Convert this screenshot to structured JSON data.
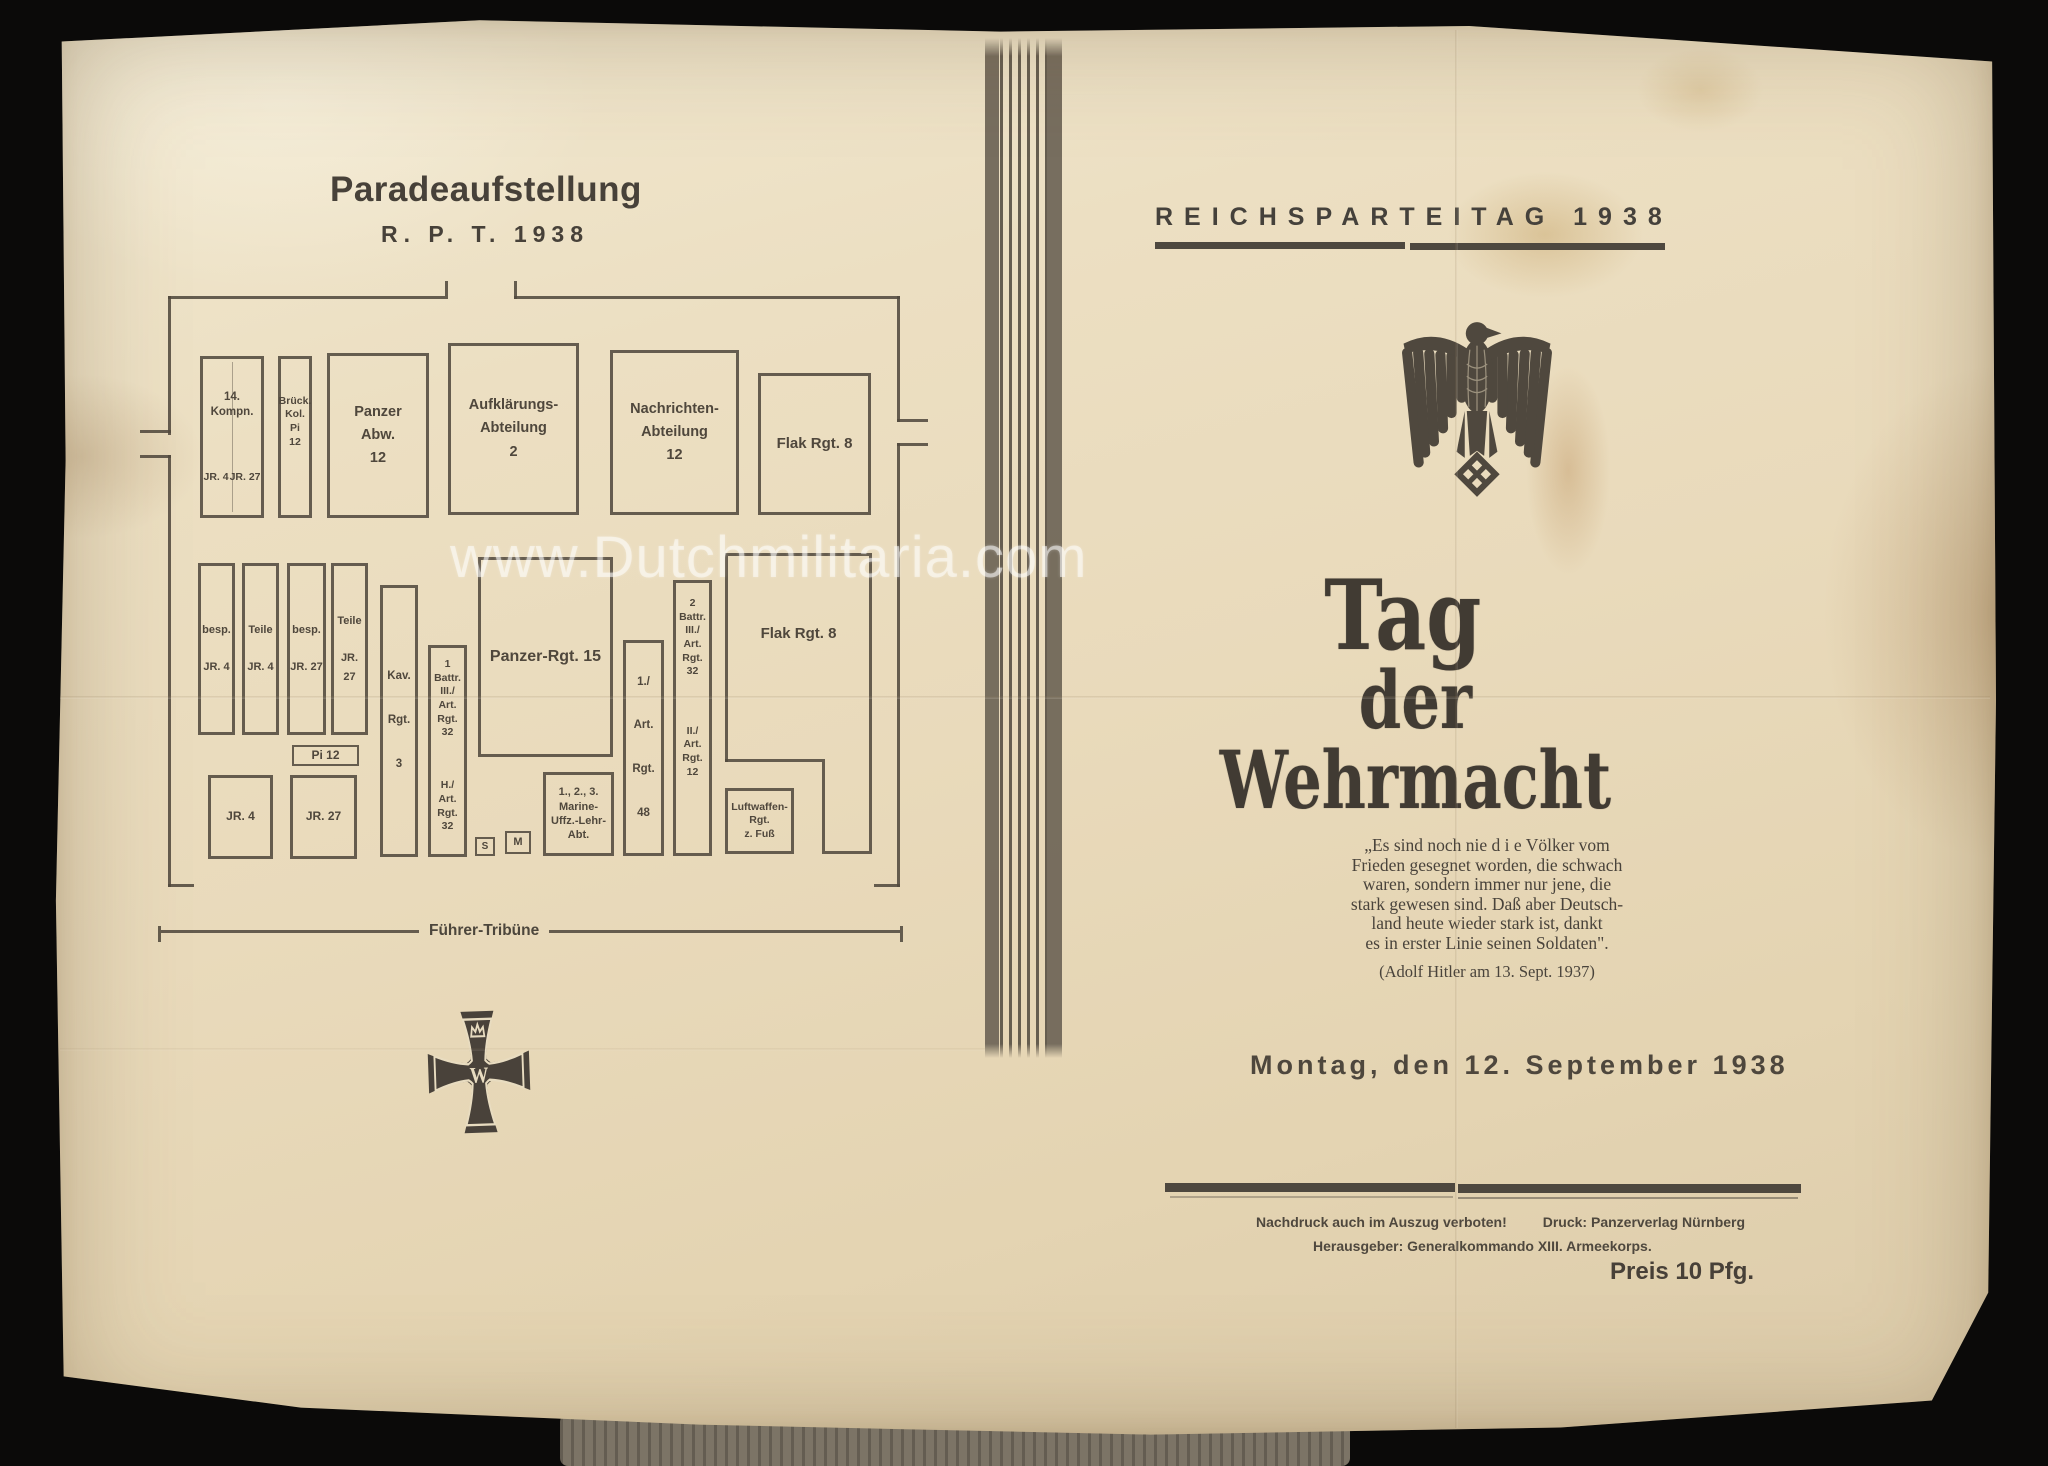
{
  "photo": {
    "watermark": "www.Dutchmilitaria.com"
  },
  "left_page": {
    "title": "Paradeaufstellung",
    "subtitle": "R. P. T. 1938",
    "tribune_label": "Führer-Tribüne",
    "cross_monogram": "W",
    "boxes": {
      "kompn14": "14. Kompn.",
      "kompn14_jr4": "JR. 4",
      "kompn14_jr27": "JR. 27",
      "brueck": "Brück.\nKol.\nPi\n12",
      "panzer_abw": "Panzer\nAbw.\n12",
      "aufklaerungs": "Aufklärungs-\nAbteilung\n2",
      "nachrichten": "Nachrichten-\nAbteilung\n12",
      "flak_rgt8_top": "Flak Rgt. 8",
      "besp_jr4": "besp.\n\nJR. 4",
      "teile_jr4": "Teile\n\nJR. 4",
      "besp_jr27": "besp.\n\nJR. 27",
      "teile_jr27": "Teile\n\nJR. 27",
      "kav_rgt3": "Kav.\n\nRgt.\n\n3",
      "battr1_art32": "1\nBattr.\nIII./\nArt.\nRgt.\n32",
      "h_art_rgt32": "H./\nArt.\nRgt.\n32",
      "panzer_rgt15": "Panzer-Rgt. 15",
      "pi12": "Pi 12",
      "jr4": "JR. 4",
      "jr27": "JR. 27",
      "s": "S",
      "m": "M",
      "marine": "1., 2., 3.\nMarine-\nUffz.-Lehr-\nAbt.",
      "art_rgt48": "1./\n\nArt.\n\nRgt.\n\n48",
      "battr2_art32": "2\nBattr.\nIII./\nArt.\nRgt.\n32",
      "art_rgt12": "II./\nArt.\nRgt.\n12",
      "flak_rgt8_bottom": "Flak Rgt. 8",
      "luftwaffen": "Luftwaffen-\nRgt.\nz. Fuß"
    }
  },
  "right_page": {
    "header": "REICHSPARTEITAG 1938",
    "title_line1": "Tag",
    "title_line2": "der Wehrmacht",
    "quote": "„Es sind noch nie d i e Völker vom\nFrieden gesegnet worden, die schwach\nwaren, sondern immer nur jene, die\nstark gewesen sind. Daß aber Deutsch-\nland heute wieder stark ist, dankt\nes in erster Linie seinen Soldaten\".",
    "attribution": "(Adolf Hitler am 13. Sept. 1937)",
    "date": "Montag, den 12. September 1938",
    "imprint_notice": "Nachdruck auch im Auszug verboten!",
    "imprint_printer": "Druck: Panzerverlag Nürnberg",
    "imprint_publisher": "Herausgeber: Generalkommando XIII. Armeekorps.",
    "price": "Preis 10 Pfg."
  }
}
